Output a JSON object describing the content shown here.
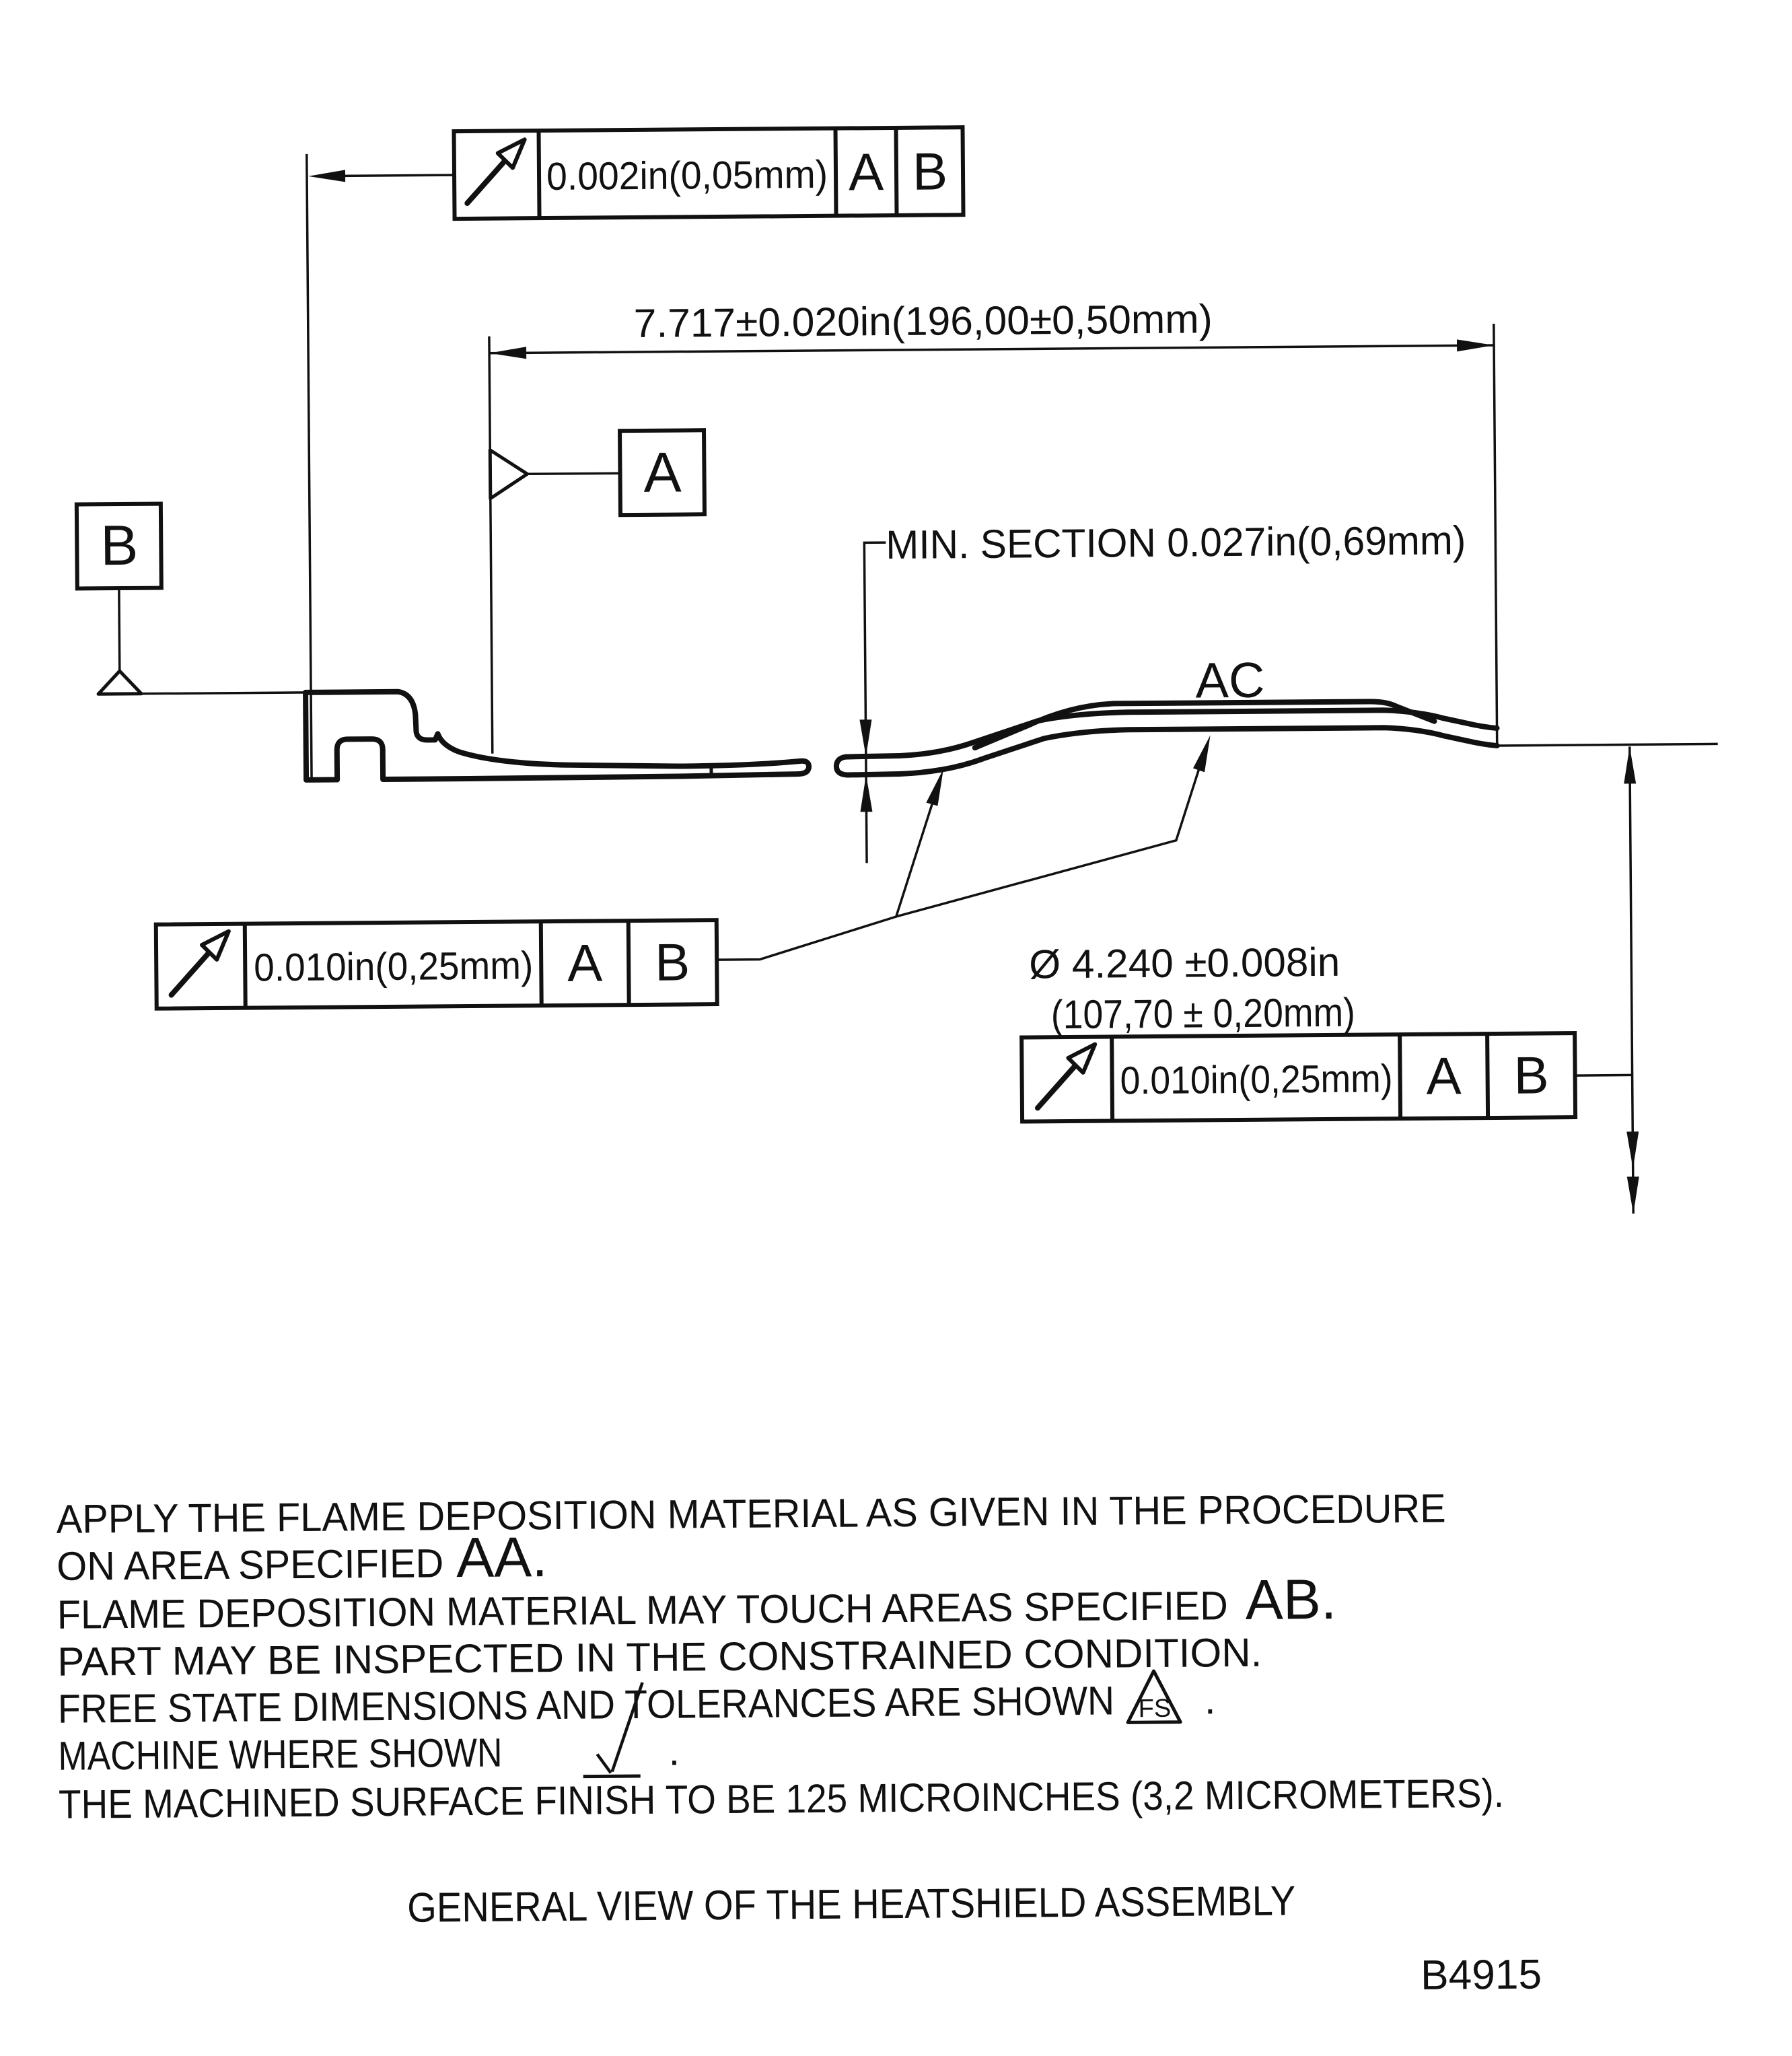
{
  "drawing": {
    "fcf_top": {
      "tolerance": "0.002in(0,05mm)",
      "datum_a": "A",
      "datum_b": "B"
    },
    "length_dim": "7.717±0.020in(196,00±0,50mm)",
    "datum_a_label": "A",
    "datum_b_label": "B",
    "min_section": "MIN. SECTION 0.027in(0,69mm)",
    "area_label": "AC",
    "fcf_lower_left": {
      "tolerance": "0.010in(0,25mm)",
      "datum_a": "A",
      "datum_b": "B"
    },
    "diameter_dim": {
      "inches": "Ø 4.240 ±0.008in",
      "millimeters": "(107,70 ± 0,20mm)"
    },
    "fcf_lower_right": {
      "tolerance": "0.010in(0,25mm)",
      "datum_a": "A",
      "datum_b": "B"
    },
    "notes": {
      "line1": "APPLY THE FLAME DEPOSITION MATERIAL AS GIVEN IN THE PROCEDURE",
      "line2_prefix": "ON AREA SPECIFIED",
      "line2_area": "AA.",
      "line3_prefix": "FLAME DEPOSITION MATERIAL MAY TOUCH AREAS SPECIFIED",
      "line3_area": "AB.",
      "line4": "PART MAY BE INSPECTED IN THE CONSTRAINED CONDITION.",
      "line5": "FREE STATE DIMENSIONS AND TOLERANCES ARE SHOWN",
      "line5_symbol": "FS",
      "line5_suffix": ".",
      "line6": "MACHINE WHERE SHOWN",
      "line6_suffix": ".",
      "line7": "THE MACHINED SURFACE FINISH TO BE 125 MICROINCHES (3,2 MICROMETERS)."
    },
    "title": "GENERAL VIEW OF THE HEATSHIELD ASSEMBLY",
    "drawing_number": "B4915"
  }
}
